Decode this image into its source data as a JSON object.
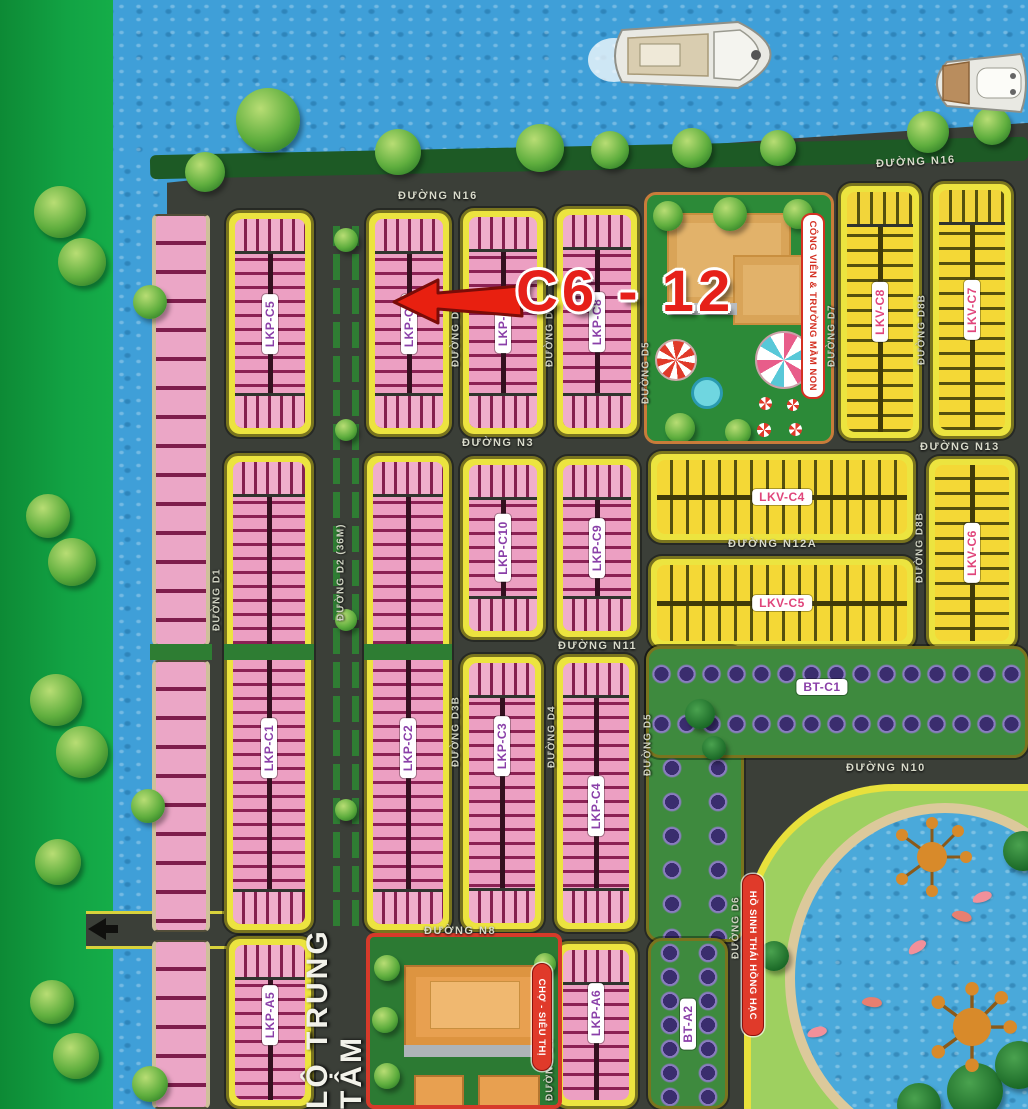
{
  "title": "Residential land subdivision master plan",
  "annotation": {
    "text": "C6 - 12"
  },
  "streets": {
    "n16": "ĐƯỜNG N16",
    "n3": "ĐƯỜNG N3",
    "n8": "ĐƯỜNG N8",
    "n10": "ĐƯỜNG N10",
    "n11": "ĐƯỜNG N11",
    "n12a": "ĐƯỜNG N12A",
    "n13": "ĐƯỜNG N13",
    "d1": "ĐƯỜNG D1",
    "d2": "ĐƯỜNG D2 (36M)",
    "d3b": "ĐƯỜNG D3B",
    "d4": "ĐƯỜNG D4",
    "d5": "ĐƯỜNG D5",
    "d6": "ĐƯỜNG D6",
    "d7": "ĐƯỜNG D7",
    "d8b": "ĐƯỜNG D8B",
    "central": "LỘ TRUNG TÂM"
  },
  "blocks": {
    "lkp_c1": "LKP-C1",
    "lkp_c2": "LKP-C2",
    "lkp_c3": "LKP-C3",
    "lkp_c4": "LKP-C4",
    "lkp_c5": "LKP-C5",
    "lkp_c6": "LKP-C6",
    "lkp_c7": "LKP-C7",
    "lkp_c8": "LKP-C8",
    "lkp_c9": "LKP-C9",
    "lkp_c10": "LKP-C10",
    "lkp_a5": "LKP-A5",
    "lkp_a6": "LKP-A6",
    "lkv_c4": "LKV-C4",
    "lkv_c5": "LKV-C5",
    "lkv_c6": "LKV-C6",
    "lkv_c7": "LKV-C7",
    "lkv_c8": "LKV-C8",
    "bt_c1": "BT-C1",
    "bt_a2": "BT-A2"
  },
  "places": {
    "park_kindergarten": "CÔNG VIÊN & TRƯỜNG MẦM NON",
    "market": "CHỢ - SIÊU THỊ",
    "lake": "HỒ SINH THÁI HỒNG HẠC"
  },
  "colors": {
    "road": "#3b3f38",
    "water": "#3f9fd8",
    "block_border_yellow": "#ece43f",
    "lot_pink": "#ec9fc2",
    "lot_pink_divider": "#8b2154",
    "lot_yellow": "#f4d836",
    "greenbelt": "#12a344",
    "label_purple": "#8a3fa8",
    "label_pink": "#e0457b",
    "highlight_red": "#e62019"
  }
}
